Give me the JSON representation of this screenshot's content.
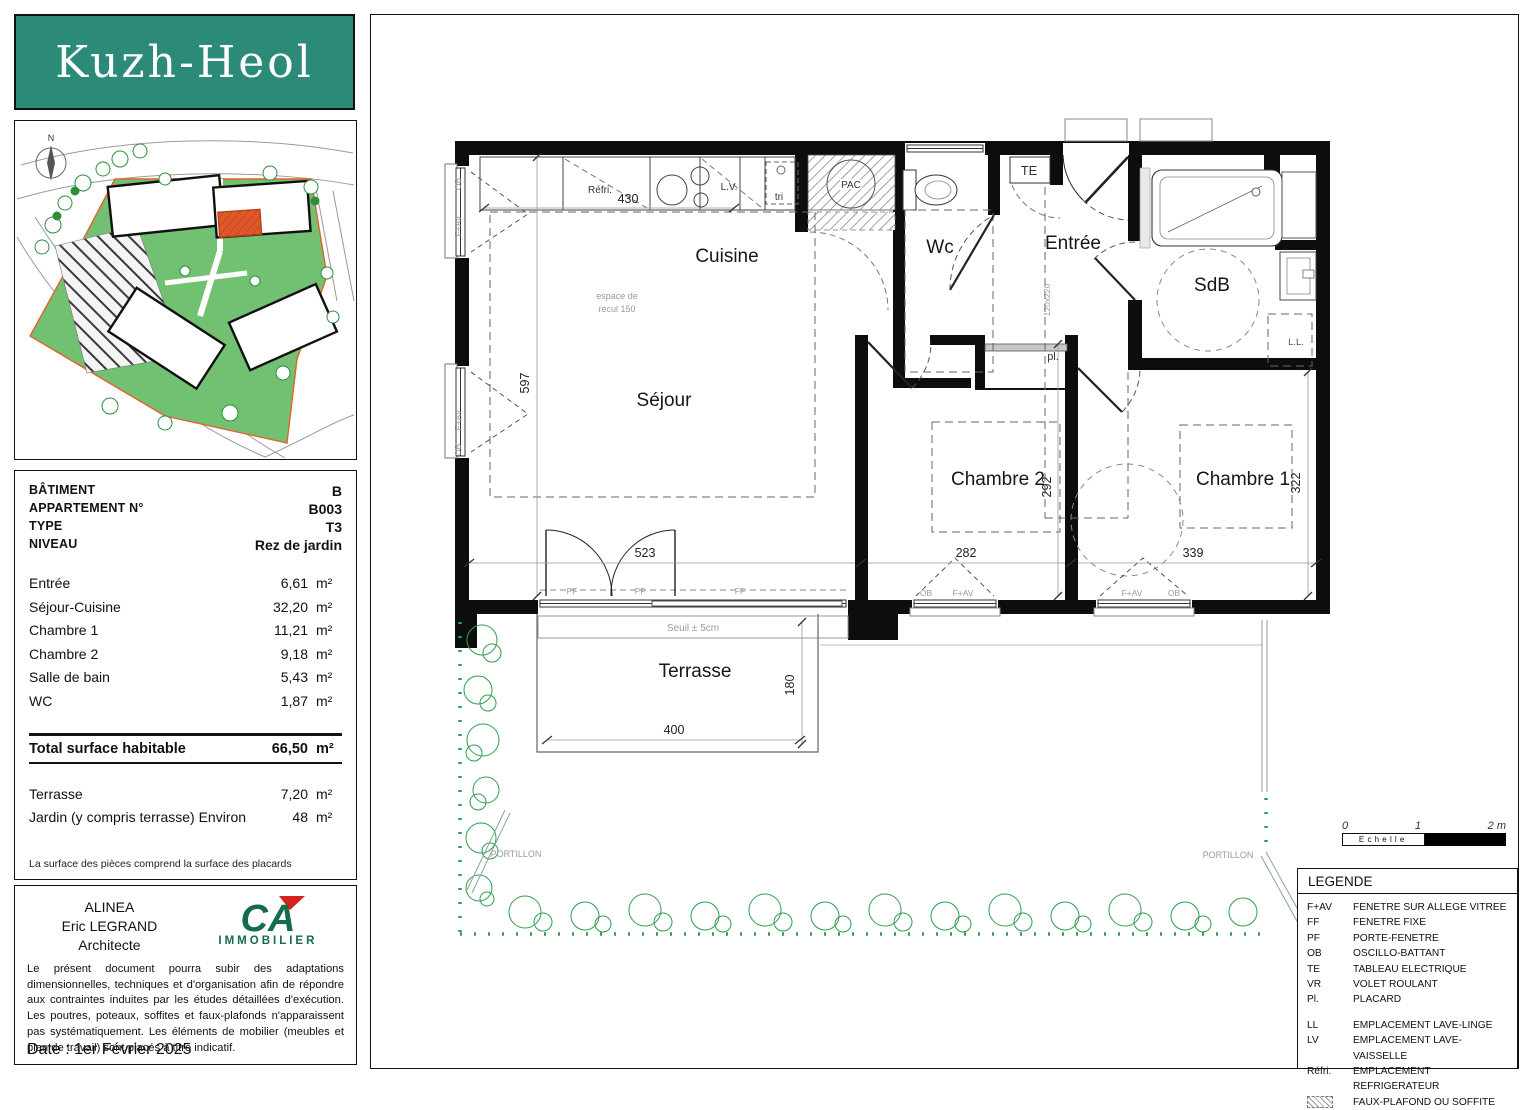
{
  "colors": {
    "teal": "#2c8a79",
    "site_green": "#72c173",
    "boundary_orange": "#e2622b",
    "unit_orange": "#e0582a",
    "hedge_green": "#2f9e4f",
    "ca_green": "#156b4a",
    "ca_red": "#d6221f"
  },
  "logo": {
    "title": "Kuzh-Heol"
  },
  "site_map": {
    "north": "N"
  },
  "info": {
    "fields": [
      {
        "label": "BÂTIMENT",
        "value": "B"
      },
      {
        "label": "APPARTEMENT N°",
        "value": "B003"
      },
      {
        "label": "TYPE",
        "value": "T3"
      },
      {
        "label": "NIVEAU",
        "value": "Rez de jardin"
      }
    ],
    "rooms": [
      {
        "label": "Entrée",
        "value": "6,61",
        "unit": "m²"
      },
      {
        "label": "Séjour-Cuisine",
        "value": "32,20",
        "unit": "m²"
      },
      {
        "label": "Chambre 1",
        "value": "11,21",
        "unit": "m²"
      },
      {
        "label": "Chambre 2",
        "value": "9,18",
        "unit": "m²"
      },
      {
        "label": "Salle de bain",
        "value": "5,43",
        "unit": "m²"
      },
      {
        "label": "WC",
        "value": "1,87",
        "unit": "m²"
      }
    ],
    "total": {
      "label": "Total surface habitable",
      "value": "66,50",
      "unit": "m²"
    },
    "outdoor": [
      {
        "label": "Terrasse",
        "value": "7,20",
        "unit": "m²"
      },
      {
        "label": "Jardin (y compris terrasse) Environ",
        "value": "48",
        "unit": "m²"
      }
    ],
    "footnote": "La surface des pièces comprend la surface des placards"
  },
  "architect": {
    "firm": "ALINEA",
    "name": "Eric LEGRAND",
    "role": "Architecte",
    "brand": "CA",
    "brand_sub": "IMMOBILIER",
    "disclaimer": "Le présent document pourra subir des adaptations dimensionnelles, techniques et d'organisation afin de répondre aux contraintes induites par les études détaillées d'exécution. Les poutres, poteaux, soffites et faux-plafonds n'apparaissent pas systématiquement. Les éléments de mobilier (meubles et plan de travail) sont placés à titre indicatif.",
    "date": "Date : 1er Février 2025"
  },
  "plan": {
    "rooms": {
      "cuisine": "Cuisine",
      "sejour": "Séjour",
      "wc": "Wc",
      "entree": "Entrée",
      "sdb": "SdB",
      "chambre2": "Chambre 2",
      "chambre1": "Chambre 1",
      "terrasse": "Terrasse"
    },
    "labels": {
      "refri": "Réfri.",
      "lv": "L.V.",
      "tri": "tri",
      "pac": "PAC",
      "te": "TE",
      "pl": "pl.",
      "ll": "L.L.",
      "door_size": "120x220",
      "espace_line1": "espace de",
      "espace_line2": "recul 150",
      "seuil": "Seuil ± 5cm",
      "portillon": "PORTILLON"
    },
    "dims": {
      "d430": "430",
      "d597": "597",
      "d523": "523",
      "d282": "282",
      "d292": "292",
      "d339": "339",
      "d322": "322",
      "d400": "400",
      "d180": "180"
    },
    "windows": {
      "pf": "PF",
      "ff": "FF",
      "fav": "F+AV",
      "ob": "OB"
    }
  },
  "scale": {
    "label": "Echelle",
    "ticks": [
      "0",
      "1",
      "2 m"
    ]
  },
  "legend": {
    "title": "LEGENDE",
    "items": [
      {
        "abbr": "F+AV",
        "label": "FENETRE SUR ALLEGE VITREE"
      },
      {
        "abbr": "FF",
        "label": "FENETRE FIXE"
      },
      {
        "abbr": "PF",
        "label": "PORTE-FENETRE"
      },
      {
        "abbr": "OB",
        "label": "OSCILLO-BATTANT"
      },
      {
        "abbr": "TE",
        "label": "TABLEAU ELECTRIQUE"
      },
      {
        "abbr": "VR",
        "label": "VOLET ROULANT"
      },
      {
        "abbr": "Pl.",
        "label": "PLACARD"
      }
    ],
    "items2": [
      {
        "abbr": "LL",
        "label": "EMPLACEMENT LAVE-LINGE"
      },
      {
        "abbr": "LV",
        "label": "EMPLACEMENT LAVE-VAISSELLE"
      },
      {
        "abbr": "Réfri.",
        "label": "EMPLACEMENT REFRIGERATEUR"
      },
      {
        "abbr": "",
        "label": "FAUX-PLAFOND OU SOFFITE"
      }
    ]
  }
}
